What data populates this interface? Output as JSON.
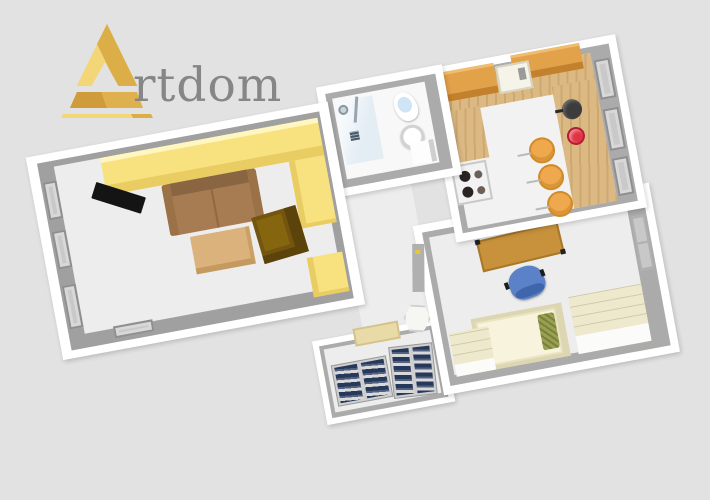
{
  "canvas": {
    "background": "#e2e2e2"
  },
  "logo": {
    "initial": "A",
    "rest": "rtdom",
    "full_name": "Artdom",
    "gold_light": "#f2d678",
    "gold_dark": "#dcae48",
    "crossbar": "#dfb04e",
    "text_color": "#868686"
  },
  "floorplan": {
    "wall": "#ffffff",
    "wall_inner": "#ababab",
    "floor": "#ededed",
    "rooms": [
      {
        "name": "living-room"
      },
      {
        "name": "bathroom"
      },
      {
        "name": "kitchen"
      },
      {
        "name": "bedroom"
      },
      {
        "name": "hallway"
      },
      {
        "name": "closet"
      }
    ],
    "items": [
      "wardrobe",
      "tv",
      "sofa",
      "coffee-table",
      "armchair",
      "shower",
      "drain",
      "toilet",
      "sink",
      "kitchen-counter",
      "upper-cabinets",
      "kitchen-sink",
      "stove",
      "cooking-pot",
      "red-bowl",
      "bar-stools",
      "desk",
      "office-chair",
      "bed",
      "pillow",
      "dressers",
      "balcony-door",
      "shoe-shelves",
      "doormat",
      "laundry-basket",
      "windows"
    ],
    "colors": {
      "wardrobe": "#f8e280",
      "wardrobe_face": "#e9cd63",
      "tv": "#141414",
      "sofa": "#a87c52",
      "coffee_table": "#dcb27c",
      "armchair": "#745510",
      "shower": "#e3edf4",
      "toilet": "#ffffff",
      "sink": "#ffffff",
      "counter_wood": "#dcb983",
      "upper_cabinet": "#e2a24a",
      "stove": "#f2f2f2",
      "pot": "#3c3c3c",
      "red_bowl": "#e23344",
      "stool": "#f0a84e",
      "desk": "#c8923c",
      "office_chair": "#5b82c8",
      "bed_frame": "#e9e3c0",
      "mattress": "#f7f3dd",
      "pillow": "#99a052",
      "dresser": "#eee9cc",
      "shelf_items": "#27395a",
      "mat": "#e9dba8",
      "window": "#c9c9c9",
      "door": "#b0b0b0",
      "handle": "#e8c830"
    }
  }
}
